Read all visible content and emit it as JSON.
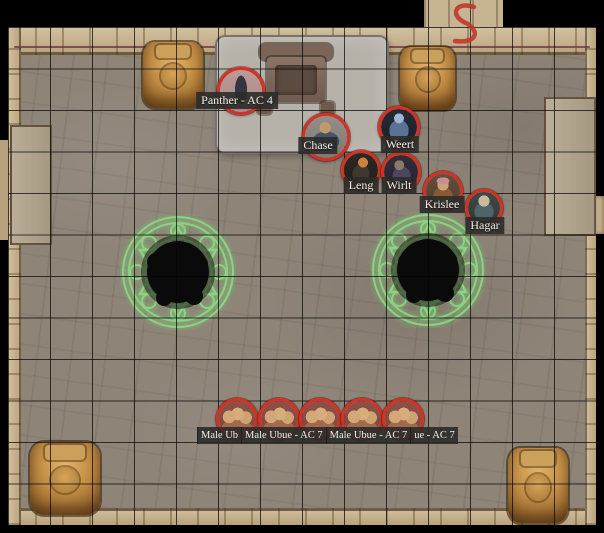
{
  "scene": {
    "type": "virtual-tabletop battle map",
    "marking": {
      "text": "S",
      "color": "#c2342c"
    }
  },
  "grid": {
    "size_px": 42,
    "line_color": "rgba(0,0,0,0.72)"
  },
  "tokens": {
    "panther": {
      "label": "Panther - AC 4"
    },
    "chase": {
      "label": "Chase"
    },
    "weert": {
      "label": "Weert"
    },
    "leng": {
      "label": "Leng"
    },
    "wirlt": {
      "label": "Wirlt"
    },
    "krislee": {
      "label": "Krislee"
    },
    "hagar": {
      "label": "Hagar"
    }
  },
  "ubue_label_segments": {
    "s1": "Male Ub",
    "s2": "Male Ubue - AC 7",
    "s3": "Male Ubue - AC 7",
    "s4": "ue - AC 7"
  },
  "colors": {
    "token_ring": "#cf3326",
    "magic_circle": "#8fd98a",
    "label_bg": "#2b2b29",
    "label_text": "#f2efe9",
    "floor": "#8e8478",
    "wall": "#c7b493",
    "platform": "#b6b2aa",
    "background": "#000000"
  }
}
